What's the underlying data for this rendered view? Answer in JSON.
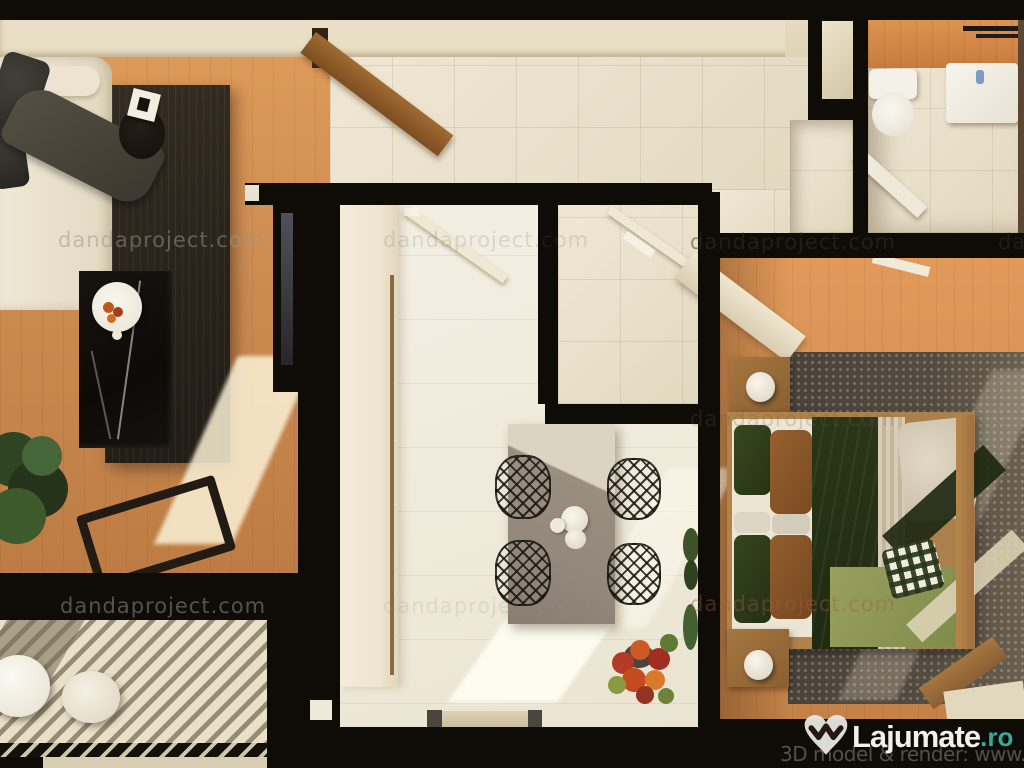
{
  "page": {
    "type": "3d-apartment-floorplan-render",
    "width": 1024,
    "height": 768
  },
  "watermark": {
    "text": "dandaproject.com",
    "tiles": [
      {
        "x": 58,
        "y": 228,
        "color": "rgba(158,150,138,0.50)",
        "size": 21
      },
      {
        "x": 383,
        "y": 228,
        "color": "rgba(95,85,68,0.16)",
        "size": 21
      },
      {
        "x": 690,
        "y": 230,
        "color": "rgba(55,47,38,0.50)",
        "size": 21
      },
      {
        "x": 998,
        "y": 230,
        "color": "rgba(55,47,38,0.45)",
        "size": 21
      },
      {
        "x": 690,
        "y": 407,
        "color": "rgba(105,96,82,0.22)",
        "size": 21
      },
      {
        "x": 60,
        "y": 594,
        "color": "rgba(148,140,128,0.55)",
        "size": 21
      },
      {
        "x": 383,
        "y": 594,
        "color": "rgba(128,120,108,0.14)",
        "size": 21
      },
      {
        "x": 690,
        "y": 592,
        "color": "rgba(158,92,68,0.40)",
        "size": 21
      }
    ]
  },
  "credit": {
    "text": "3D model & render: www.dandaproject.com"
  },
  "branding": {
    "logo_text": "Lajumate",
    "logo_tld": ".ro"
  },
  "palette": {
    "wall-black": "#0f0b07",
    "cream-band": "#e9dfc6",
    "wood-floor": "#cd8c52",
    "hall-tile": "#ebe2cd",
    "kitchen-floor": "#f2ecdf",
    "living-rug": "#2a241c",
    "bed-green": "#2c3a1a",
    "bed-olive": "#8d9455",
    "logo-white": "#f2f0ea",
    "logo-teal": "#36a99a",
    "credit-gray": "#847c71"
  }
}
